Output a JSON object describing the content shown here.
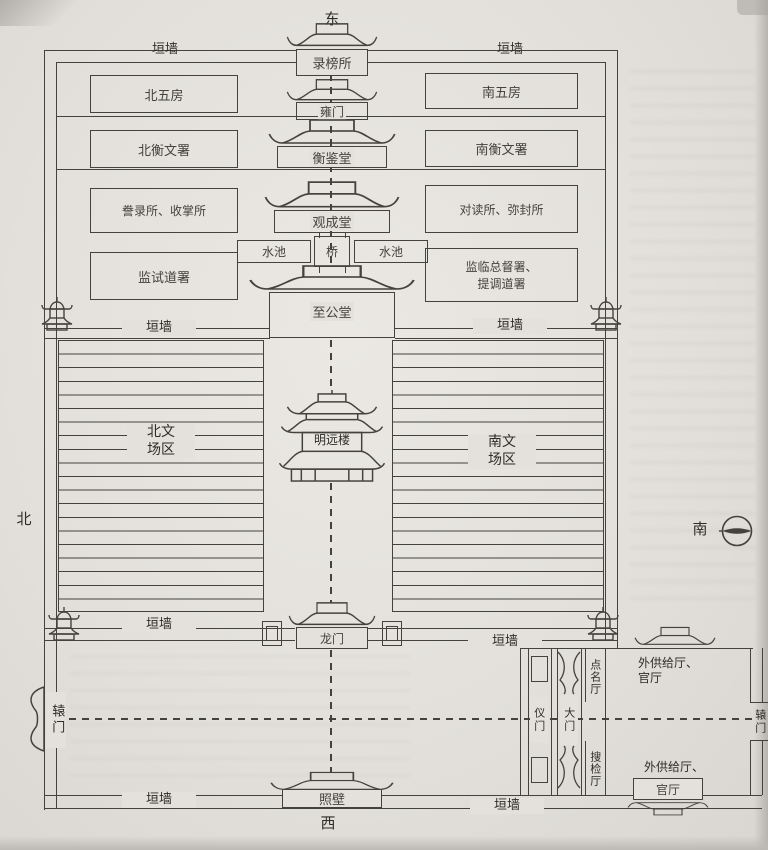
{
  "colors": {
    "ink": "#44423e",
    "paper": "#e4e1dc"
  },
  "orientation": {
    "east": "东",
    "west": "西",
    "north": "北",
    "south": "南"
  },
  "wall_label": "垣墙",
  "admin": {
    "lubang_office": "录榜所",
    "yong_gate": "雍门",
    "north_five_rooms": "北五房",
    "south_five_rooms": "南五房",
    "north_hengwen_office": "北衡文署",
    "hengjian_hall": "衡鉴堂",
    "south_hengwen_office": "南衡文署",
    "copy_office": "誊录所、收掌所",
    "guancheng_hall": "观成堂",
    "proofread_office": "对读所、弥封所",
    "pond": "水池",
    "bridge": "桥",
    "jianshi_office": "监试道署",
    "jianlin_office_line1": "监临总督署、",
    "jianlin_office_line2": "提调道署",
    "zhigong_hall": "至公堂"
  },
  "field": {
    "north_zone_line1": "北文",
    "north_zone_line2": "场区",
    "south_zone_line1": "南文",
    "south_zone_line2": "场区",
    "mingyuan_tower": "明远楼",
    "dragon_gate": "龙门"
  },
  "entrance": {
    "yuan_gate": "辕门",
    "yi_gate": "仪门",
    "main_gate": "大门",
    "rollcall_hall": "点名厅",
    "search_hall": "搜检厅",
    "supply_hall_line1": "外供给厅、",
    "supply_hall_line2": "官厅",
    "screen_wall": "照壁"
  }
}
